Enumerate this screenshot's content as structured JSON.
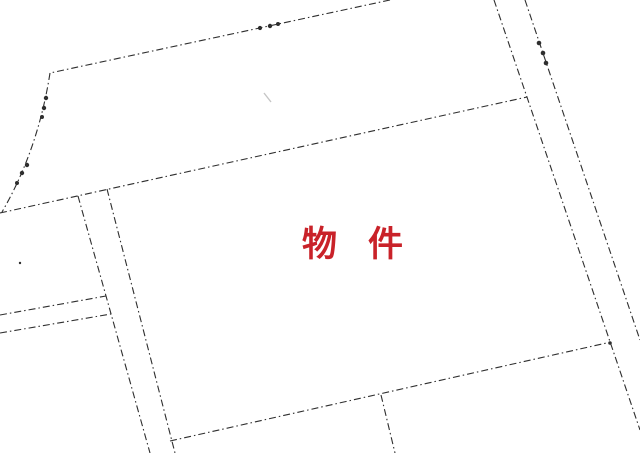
{
  "map": {
    "description": "scanned cadastral parcel map",
    "background_color": "#ffffff",
    "line_color": "#2e2e2e",
    "dash_pattern": "7 3 1.5 3",
    "line_width": 1.1,
    "label": {
      "text": "物　件",
      "color": "#c92229",
      "x": 302,
      "y": 227,
      "font_size": 35,
      "letter_spacing": -2
    },
    "boundary_lines": [
      {
        "name": "north-boundary-line",
        "path": "M390,0 L50,73"
      },
      {
        "name": "west-boundary-curve",
        "path": "M50,73 Q38,150 2,212"
      },
      {
        "name": "main-diagonal-boundary",
        "path": "M0,213 L527,97"
      },
      {
        "name": "west-road-left-edge",
        "path": "M78,196 L150,453"
      },
      {
        "name": "west-road-right-edge",
        "path": "M107,189 L175,453"
      },
      {
        "name": "branch-road-upper-edge",
        "path": "M0,315 L106,296"
      },
      {
        "name": "branch-road-lower-edge",
        "path": "M0,333 L111,314"
      },
      {
        "name": "east-road-left-edge",
        "path": "M494,0 L640,430"
      },
      {
        "name": "east-road-right-edge",
        "path": "M525,0 L640,340"
      },
      {
        "name": "parcel-south-boundary",
        "path": "M170,441 L611,342"
      },
      {
        "name": "south-parcel-divider",
        "path": "M381,395 L395,453"
      }
    ],
    "survey_points": [
      {
        "x": 260,
        "y": 28,
        "r": 2.1
      },
      {
        "x": 270,
        "y": 26,
        "r": 2.2
      },
      {
        "x": 278,
        "y": 24,
        "r": 2.0
      },
      {
        "x": 46,
        "y": 98,
        "r": 2.2
      },
      {
        "x": 44,
        "y": 108,
        "r": 2.2
      },
      {
        "x": 42,
        "y": 117,
        "r": 2.0
      },
      {
        "x": 27,
        "y": 165,
        "r": 2.2
      },
      {
        "x": 22,
        "y": 173,
        "r": 2.2
      },
      {
        "x": 17,
        "y": 183,
        "r": 2.0
      },
      {
        "x": 539,
        "y": 43,
        "r": 2.3
      },
      {
        "x": 543,
        "y": 53,
        "r": 2.3
      },
      {
        "x": 546,
        "y": 63,
        "r": 2.3
      },
      {
        "x": 610,
        "y": 343,
        "r": 1.8
      },
      {
        "x": 20,
        "y": 263,
        "r": 1.2
      }
    ],
    "faint_marks": [
      {
        "name": "faint-smudge",
        "path": "M264,93 L271,102",
        "color": "#c5c5c5",
        "width": 1.4
      }
    ]
  }
}
